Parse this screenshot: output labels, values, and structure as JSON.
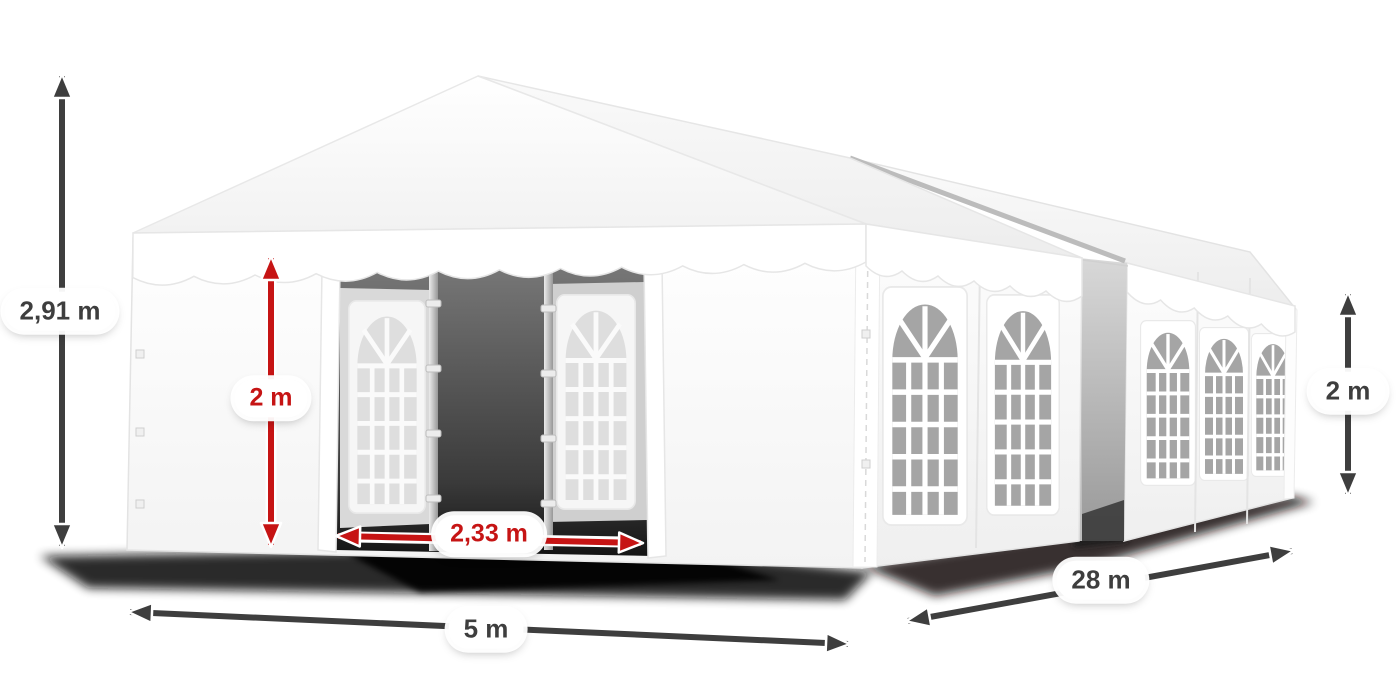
{
  "figure": {
    "name": "Marquee tent with dimension arrows",
    "dimensions": {
      "total_height": {
        "value": "2,91 m",
        "style": "dark"
      },
      "side_clear_height": {
        "value": "2 m",
        "style": "red"
      },
      "entrance_width": {
        "value": "2,33 m",
        "style": "red"
      },
      "span_width": {
        "value": "5 m",
        "style": "dark"
      },
      "length": {
        "value": "28 m",
        "style": "dark"
      },
      "side_wall_height": {
        "value": "2 m",
        "style": "dark"
      }
    },
    "colors": {
      "dimension_dark": "#3e3e3e",
      "dimension_red": "#c61414",
      "label_background": "#ffffff",
      "background": "#ffffff",
      "tent_white": "#ffffff",
      "window_glass": "#a5a5a5",
      "ground_shadow": "#000000"
    }
  }
}
